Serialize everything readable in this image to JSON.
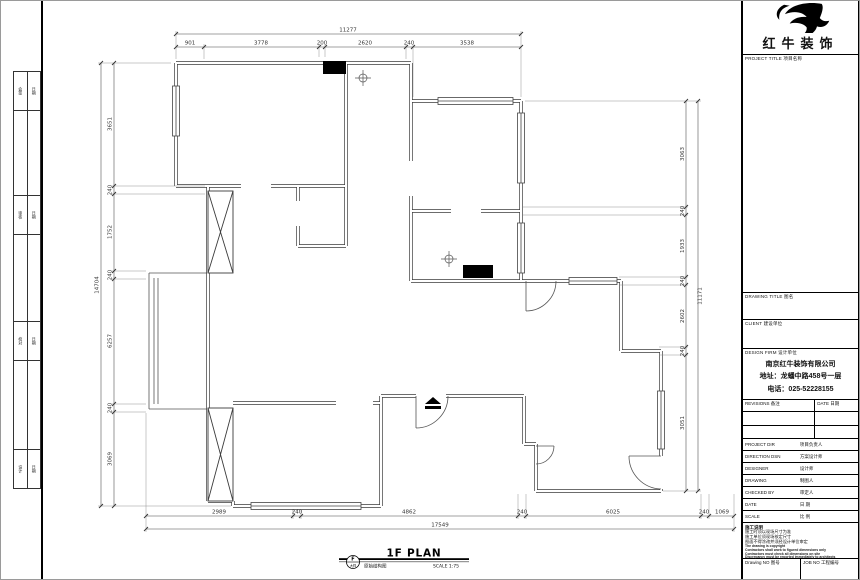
{
  "brand": {
    "name": "红牛装饰"
  },
  "titleblock": {
    "project_title": "PROJECT TITLE 项目名称",
    "drawing_title": "DRAWING TITLE 图名",
    "client": "CLIENT 建设单位",
    "design_firm": "DESIGN FIRM 设计单位",
    "company_name": "南京红牛装饰有限公司",
    "company_address": "地址：龙蟠中路458号一层",
    "company_phone": "电话：025-52228155",
    "revisions_label": "REVISIONS 备注",
    "date_label": "DATE 日期",
    "rows": [
      {
        "en": "PROJECT DIR",
        "cn": "项目负责人"
      },
      {
        "en": "DIRECTION DSN",
        "cn": "方案设计师"
      },
      {
        "en": "DESIGNER",
        "cn": "设计师"
      },
      {
        "en": "DRAWING",
        "cn": "制图人"
      },
      {
        "en": "CHECKED BY",
        "cn": "审定人"
      },
      {
        "en": "DATE",
        "cn": "日  期"
      },
      {
        "en": "SCALE",
        "cn": "比  例"
      }
    ],
    "notes_title": "施工说明",
    "notes_cn": [
      "施工时须以现场尺寸为准",
      "施工单位须现场核定尺寸",
      "图面不得涂改并须经设计单位审定"
    ],
    "notes_en": [
      "The drawing is copyright",
      "Contractors shall work to figured dimensions only",
      "Contractors must check all dimensions on site",
      "Discrepancy must be reported immediately to architects"
    ],
    "drawing_no_label": "Drawing NO 图号",
    "job_no_label": "JOB NO 工程编号"
  },
  "plan": {
    "title": "1F PLAN",
    "name_cn": "原始结构图",
    "scale": "SCALE 1:75",
    "ref_letter": "F",
    "ref_sub": "大样",
    "dims": {
      "top": {
        "total": "11277",
        "segments": [
          "901",
          "3778",
          "200",
          "2620",
          "240",
          "3538"
        ]
      },
      "bottom": {
        "total": "17549",
        "segments": [
          "2989",
          "240",
          "4862",
          "240",
          "6025",
          "240",
          "1069"
        ]
      },
      "left": {
        "total": "14704",
        "segments": [
          "3651",
          "240",
          "1752",
          "240",
          "6257",
          "240",
          "3069"
        ]
      },
      "right": {
        "total": "11171",
        "segments": [
          "3063",
          "240",
          "1933",
          "240",
          "2602",
          "240",
          "3051"
        ]
      }
    }
  },
  "sign_strip": {
    "rows": [
      [
        "会签",
        "日期"
      ],
      [
        "审核",
        "日期"
      ],
      [
        "校对",
        "日期"
      ],
      [
        "设计",
        "日期"
      ]
    ]
  }
}
